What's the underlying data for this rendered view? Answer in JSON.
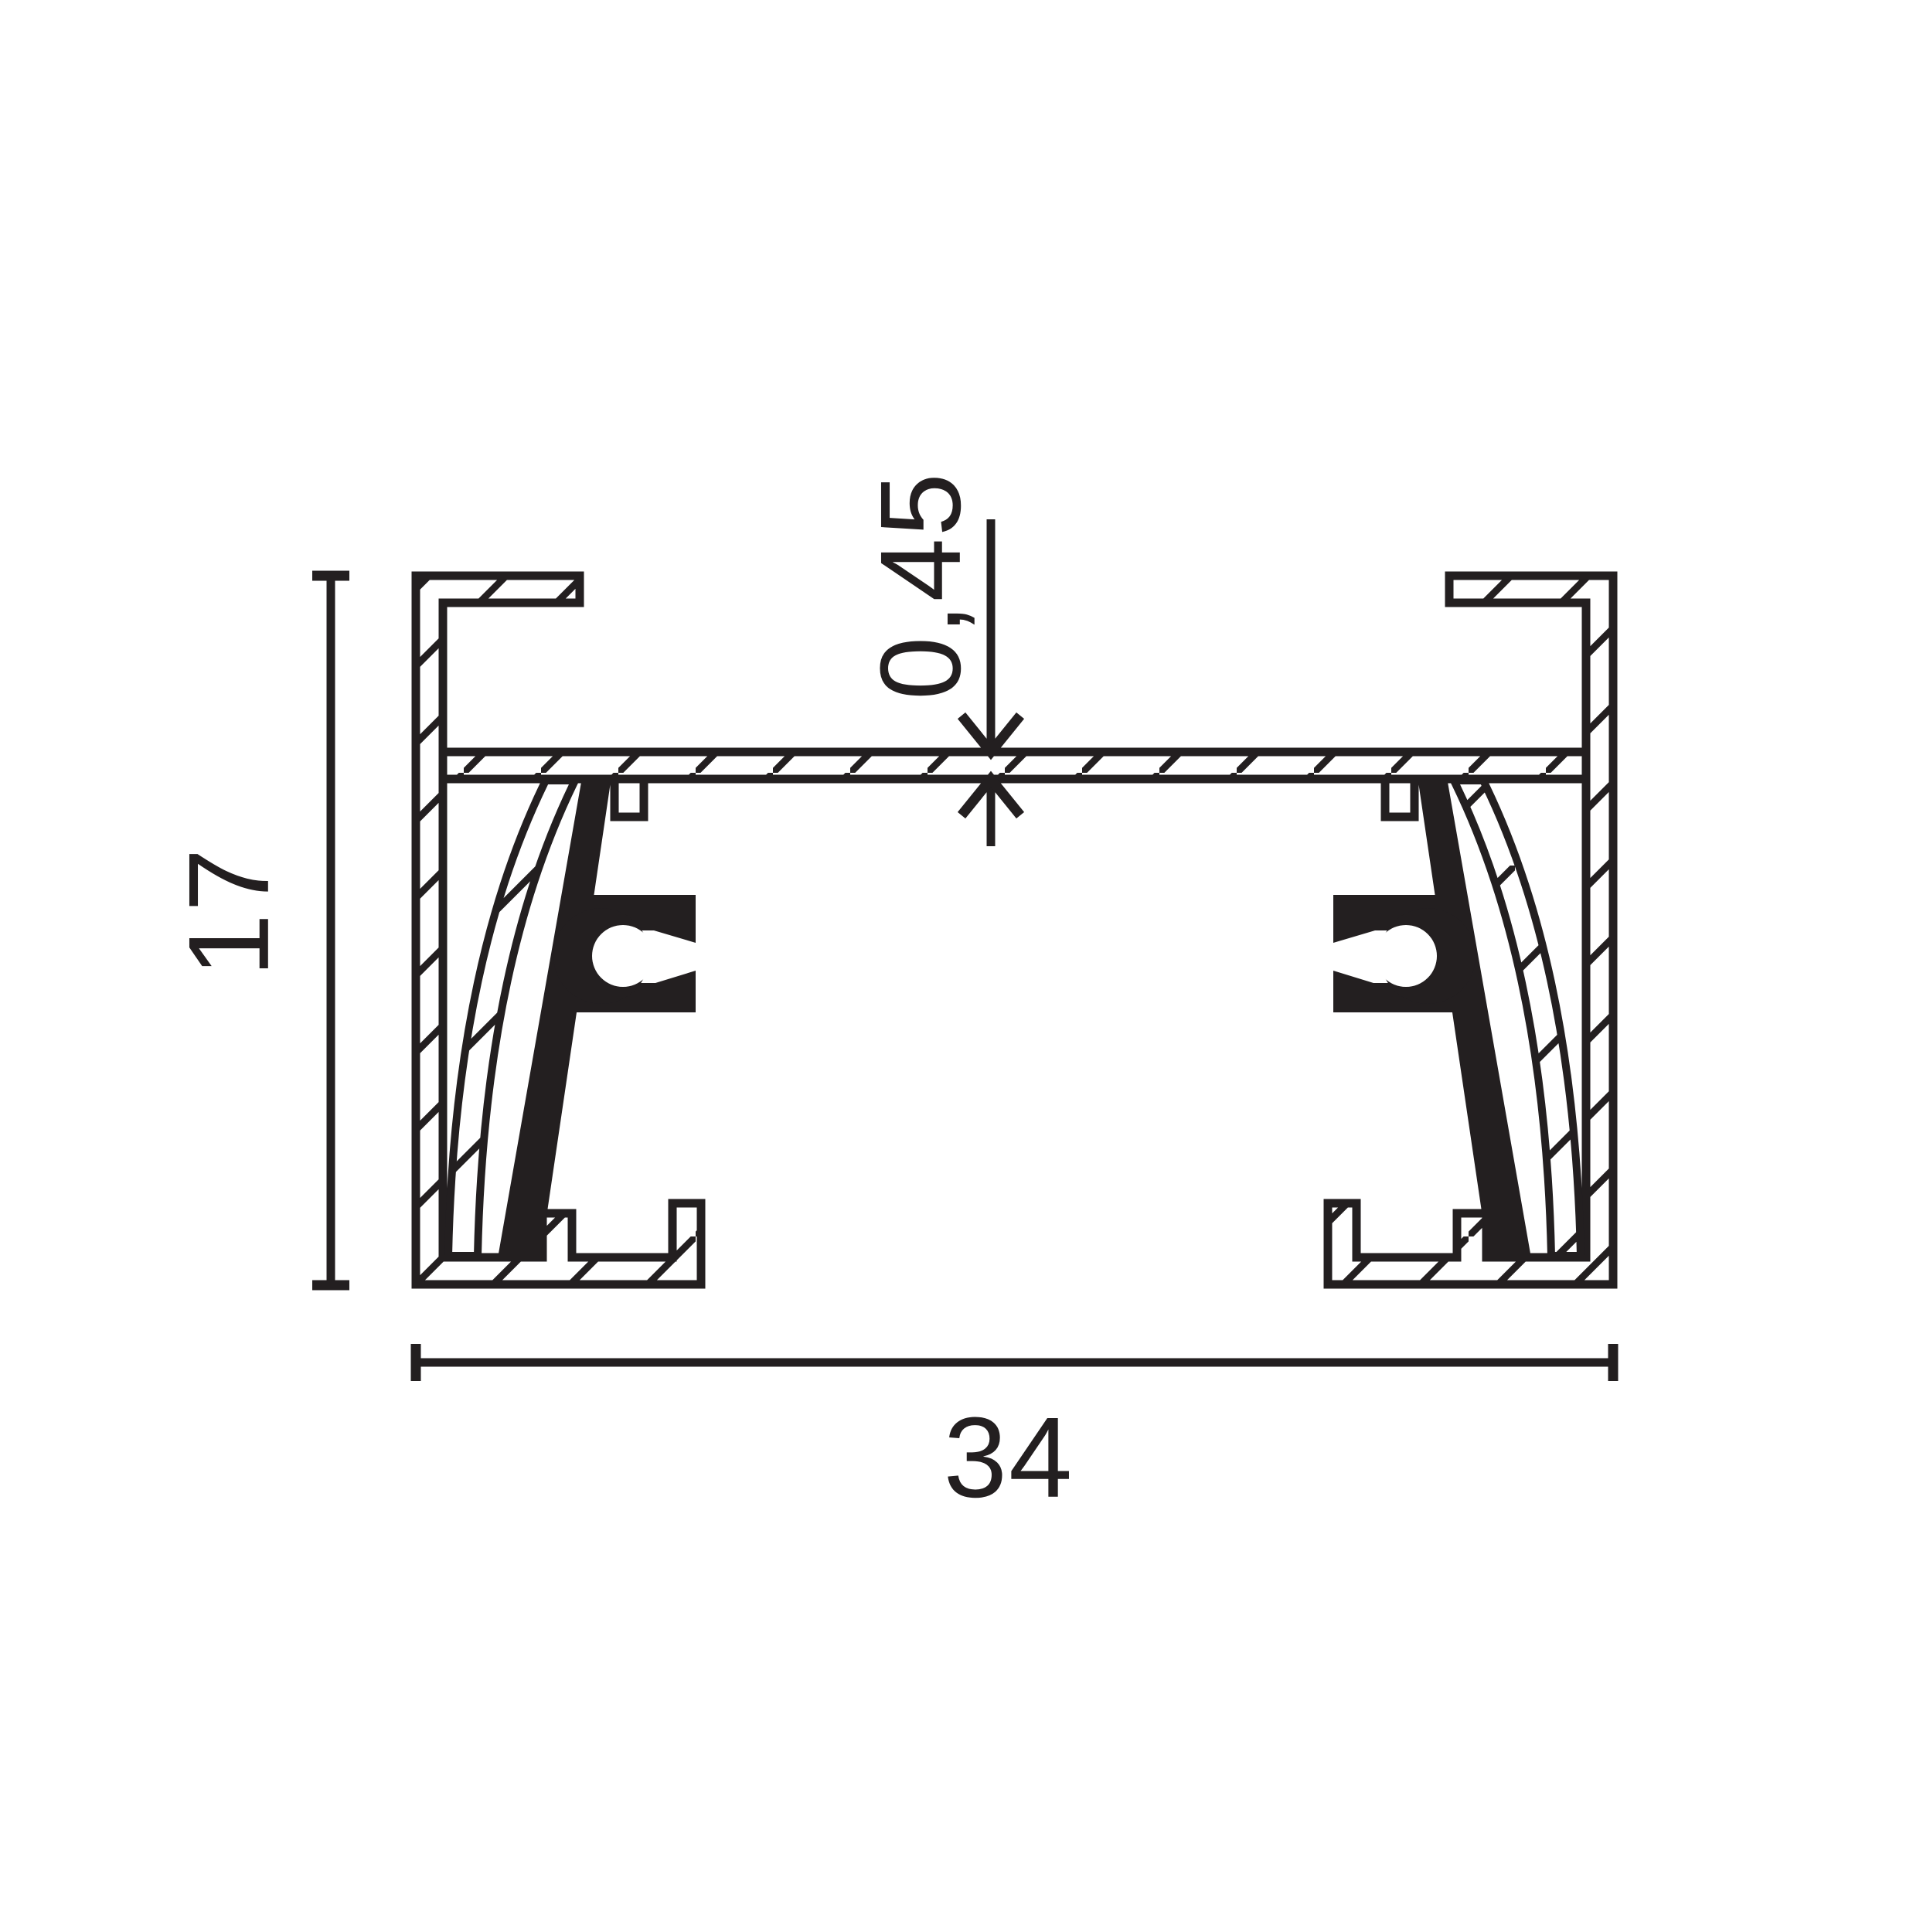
{
  "page": {
    "background_color": "#ffffff",
    "ink_color": "#231f20"
  },
  "drawing": {
    "kind": "profile-cross-section",
    "dimensions": {
      "height": {
        "label": "17",
        "orientation": "vertical"
      },
      "width": {
        "label": "34",
        "orientation": "horizontal"
      },
      "wall_thickness": {
        "label": "0,45",
        "orientation": "vertical"
      }
    },
    "parts": {
      "aluminum_shell": {
        "fill": "hatched-white",
        "outline": "#231f20"
      },
      "conductor_housing": {
        "fill": "#231f20"
      },
      "conductor_wire": {
        "fill": "#ffffff",
        "shape": "circle"
      },
      "insulator_strip": {
        "fill": "#ffffff",
        "ticks": "diagonal"
      }
    }
  }
}
